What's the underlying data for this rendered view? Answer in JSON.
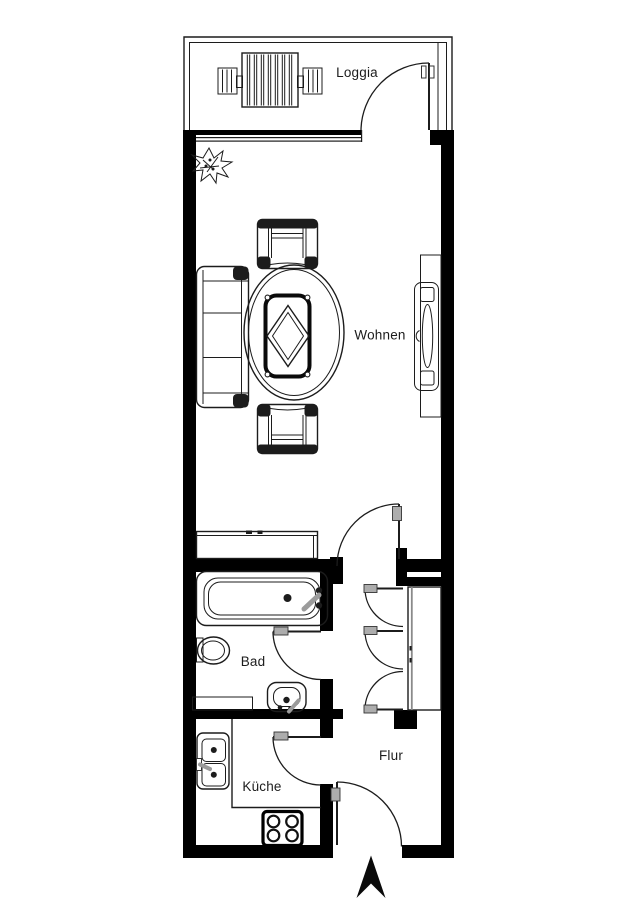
{
  "plan": {
    "rooms": [
      {
        "id": "loggia",
        "label": "Loggia"
      },
      {
        "id": "wohnen",
        "label": "Wohnen"
      },
      {
        "id": "bad",
        "label": "Bad"
      },
      {
        "id": "flur",
        "label": "Flur"
      },
      {
        "id": "kueche",
        "label": "Küche"
      }
    ],
    "colors": {
      "wall": "#000000",
      "line": "#1c1c1c",
      "background": "#ffffff",
      "handle": "#adadad",
      "fixture": "#9b9b9b",
      "text": "#1c1c1c"
    },
    "doors": [
      "loggia-door",
      "living-room-door",
      "bathroom-door",
      "kitchen-door",
      "entrance-door",
      "wardrobe-door-1",
      "wardrobe-door-2",
      "wardrobe-door-3"
    ],
    "fixtures": [
      "garden-table",
      "garden-chair-left",
      "garden-chair-right",
      "plant",
      "sofa",
      "dining-table",
      "dining-chair-top",
      "dining-chair-bottom",
      "tv-board",
      "sideboard",
      "bathtub",
      "toilet",
      "washbasin",
      "bath-shelf",
      "kitchen-sink",
      "kitchen-counter",
      "stove",
      "wardrobe",
      "north-arrow"
    ]
  }
}
